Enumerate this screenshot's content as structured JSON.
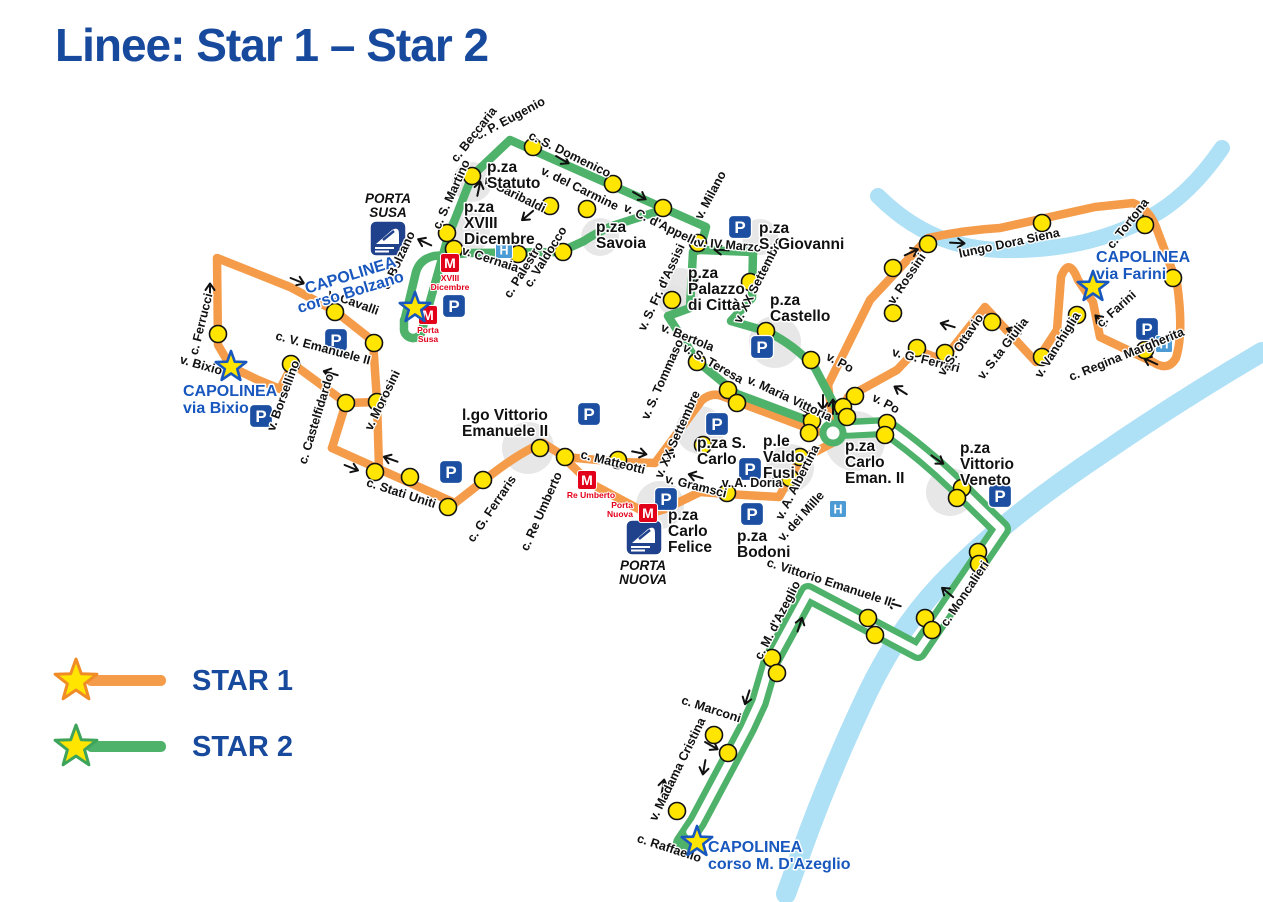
{
  "title": "Linee: Star 1 – Star 2",
  "colors": {
    "orange": "#F59C4B",
    "green": "#4FB26A",
    "stop_yellow": "#FFE500",
    "river": "#AEE0F6",
    "title_blue": "#17499D",
    "capolinea_blue": "#1857BE",
    "parking_blue": "#1C4FA1",
    "hospital_blue": "#4D9BD5",
    "metro_red": "#E2001A",
    "station_blue": "#20418C",
    "blob_gray": "#E3E3E3",
    "label_black": "#111111",
    "star_fill": "#FFE500"
  },
  "legend": {
    "items": [
      {
        "label": "STAR 1",
        "line_color": "#F59C4B",
        "star_stroke": "#F08C28"
      },
      {
        "label": "STAR 2",
        "line_color": "#4FB26A",
        "star_stroke": "#3FA45B"
      }
    ]
  },
  "map": {
    "rivers": [
      {
        "name": "river-dora",
        "d": "M878 196 Q930 248 1000 250 Q1080 252 1140 222 Q1185 202 1222 148",
        "width": 16
      },
      {
        "name": "river-po",
        "d": "M1262 352 Q1180 400 1100 455 Q1000 522 940 585 Q898 630 868 692 Q830 772 802 850 L786 894",
        "width": 20
      }
    ],
    "blobs": [
      [
        472,
        182,
        20
      ],
      [
        468,
        232,
        22
      ],
      [
        600,
        237,
        19
      ],
      [
        760,
        237,
        18
      ],
      [
        680,
        288,
        20
      ],
      [
        775,
        342,
        26
      ],
      [
        673,
        300,
        15
      ],
      [
        528,
        448,
        26
      ],
      [
        700,
        430,
        24
      ],
      [
        790,
        468,
        24
      ],
      [
        855,
        441,
        30
      ],
      [
        950,
        492,
        24
      ],
      [
        660,
        505,
        24
      ]
    ],
    "routes": {
      "star1_paths": [
        "M332 448 L346 403 L293 364 L280 389 L256 379 L231 367 L218 345 L217 258 L290 287 L335 311 L373 341 L377 401 L379 468",
        "M346 403 L377 402",
        "M332 448 L455 503 L487 478 Q520 452 543 443 L565 457 L620 462 L655 463 L702 400 Q712 392 722 396 L818 432",
        "M833 424 L828 385 L870 300 L928 238 Q965 230 1000 228 L1095 207 L1133 203 Q1149 209 1156 227 L1177 283 Q1184 332 1176 358 Q1168 372 1153 362 L1100 337 L1093 302 L1078 280 Q1069 256 1061 277 L1057 330 L1036 362 L985 307 L943 360 L916 350 L897 370 L848 397 L834 426",
        "M836 441 L800 460 L779 497 L727 494 L700 492 L665 509 L648 514 L590 483 L562 456"
      ],
      "star2_paths": [
        "M404 320 L404 328 A9 9 0 0 0 422 330 L448 237 L472 176 L510 140 L663 208 L706 227 L700 250 L753 252 L752 298 L731 321 L766 331 Q795 345 815 368 L836 408 L839 422",
        "M812 422 L737 394 L697 361 L668 316 L690 308 L693 252 L699 250",
        "M665 209 L612 226 Q594 234 584 241 L560 252 L470 253 L434 256 Q420 259 416 272 L405 318"
      ],
      "star2_double": "M841 429 L886 427 Q922 452 956 485 L1001 529 L918 651 L808 593 L771 661 L759 702 L747 728 L729 762 L697 822 L683 843",
      "star2_double_core": "M848 429 L886 427 Q922 452 956 485 L1001 529 L918 651 L808 593 L771 661 L759 702 L747 728 L729 762 L697 822 L690 832",
      "hook": [
        833,
        433,
        10
      ]
    },
    "stops": [
      [
        447,
        233
      ],
      [
        454,
        249
      ],
      [
        472,
        176
      ],
      [
        533,
        147
      ],
      [
        613,
        184
      ],
      [
        663,
        208
      ],
      [
        698,
        243
      ],
      [
        750,
        282
      ],
      [
        766,
        331
      ],
      [
        811,
        360
      ],
      [
        672,
        300
      ],
      [
        697,
        362
      ],
      [
        728,
        390
      ],
      [
        737,
        403
      ],
      [
        518,
        254
      ],
      [
        563,
        252
      ],
      [
        587,
        209
      ],
      [
        550,
        206
      ],
      [
        855,
        396
      ],
      [
        843,
        407
      ],
      [
        847,
        417
      ],
      [
        812,
        421
      ],
      [
        809,
        433
      ],
      [
        887,
        423
      ],
      [
        885,
        435
      ],
      [
        962,
        488
      ],
      [
        957,
        498
      ],
      [
        978,
        552
      ],
      [
        979,
        564
      ],
      [
        925,
        618
      ],
      [
        932,
        630
      ],
      [
        868,
        618
      ],
      [
        875,
        635
      ],
      [
        772,
        658
      ],
      [
        777,
        673
      ],
      [
        714,
        735
      ],
      [
        728,
        753
      ],
      [
        677,
        811
      ],
      [
        218,
        334
      ],
      [
        335,
        312
      ],
      [
        291,
        364
      ],
      [
        374,
        343
      ],
      [
        346,
        403
      ],
      [
        377,
        402
      ],
      [
        375,
        472
      ],
      [
        410,
        477
      ],
      [
        448,
        507
      ],
      [
        483,
        480
      ],
      [
        540,
        448
      ],
      [
        565,
        457
      ],
      [
        618,
        460
      ],
      [
        703,
        445
      ],
      [
        727,
        493
      ],
      [
        800,
        457
      ],
      [
        790,
        478
      ],
      [
        893,
        268
      ],
      [
        928,
        244
      ],
      [
        1042,
        223
      ],
      [
        1145,
        225
      ],
      [
        1173,
        278
      ],
      [
        1145,
        350
      ],
      [
        1077,
        315
      ],
      [
        1042,
        357
      ],
      [
        992,
        322
      ],
      [
        945,
        353
      ],
      [
        917,
        348
      ],
      [
        893,
        313
      ]
    ],
    "street_labels": [
      [
        "c. P. Eugenio",
        512,
        122,
        -28
      ],
      [
        "c. Beccaria",
        477,
        137,
        -52
      ],
      [
        "c. S. Martino",
        455,
        196,
        -66
      ],
      [
        "c. S. Domenico",
        568,
        158,
        26
      ],
      [
        "v. Garibaldi",
        513,
        198,
        26
      ],
      [
        "v. del Carmine",
        578,
        192,
        26
      ],
      [
        "v. C. d'Appello",
        661,
        229,
        26
      ],
      [
        "v. Milano",
        714,
        197,
        -62
      ],
      [
        "v. IV Marzo",
        729,
        249,
        5
      ],
      [
        "v. Cernaia",
        489,
        263,
        18
      ],
      [
        "c. Palestro",
        527,
        272,
        -58
      ],
      [
        "c. Valdocco",
        549,
        259,
        -58
      ],
      [
        "c. Bolzano",
        402,
        262,
        -65
      ],
      [
        "v. Cavalli",
        352,
        306,
        20
      ],
      [
        "c. Ferrucci",
        205,
        325,
        -76
      ],
      [
        "v. Bixio",
        200,
        369,
        16
      ],
      [
        "v. Borsellino",
        287,
        397,
        -70
      ],
      [
        "c. V. Emanuele II",
        322,
        352,
        15
      ],
      [
        "c. Castelfidardo",
        320,
        420,
        -73
      ],
      [
        "v. Morosini",
        386,
        402,
        -64
      ],
      [
        "c. Stati Uniti",
        400,
        497,
        18
      ],
      [
        "c. G. Ferraris",
        495,
        511,
        -56
      ],
      [
        "c. Re Umberto",
        545,
        513,
        -66
      ],
      [
        "c. Matteotti",
        612,
        466,
        14
      ],
      [
        "v. Gramsci",
        695,
        490,
        14
      ],
      [
        "v. A. Doria",
        752,
        487,
        0
      ],
      [
        "v. A. Albertina",
        801,
        484,
        -63
      ],
      [
        "v. dei Mille",
        804,
        519,
        -48
      ],
      [
        "v. XX Settembre",
        762,
        282,
        -63
      ],
      [
        "v. XX Settembre",
        681,
        436,
        -66
      ],
      [
        "v. S. Fr. d'Assisi",
        665,
        289,
        -65
      ],
      [
        "v. Bertola",
        686,
        341,
        22
      ],
      [
        "v. S. Teresa",
        711,
        367,
        30
      ],
      [
        "v. S. Tommaso",
        666,
        381,
        -66
      ],
      [
        "v. Maria Vittoria",
        788,
        402,
        25
      ],
      [
        "v. Po",
        838,
        366,
        28
      ],
      [
        "v. Po",
        884,
        407,
        28
      ],
      [
        "v. Rossini",
        910,
        281,
        -56
      ],
      [
        "v. G. Ferrari",
        925,
        364,
        14
      ],
      [
        "v. S. Ottavio",
        964,
        347,
        -56
      ],
      [
        "v. S.ta Giulia",
        1006,
        351,
        -52
      ],
      [
        "v. Vanchiglia",
        1061,
        347,
        -58
      ],
      [
        "lungo Dora Siena",
        1010,
        247,
        -12
      ],
      [
        "c. Tortona",
        1131,
        226,
        -52
      ],
      [
        "c. Farini",
        1119,
        312,
        -42
      ],
      [
        "c. Regina Margherita",
        1128,
        358,
        -22
      ],
      [
        "c. Moncalieri",
        968,
        596,
        -56
      ],
      [
        "c. Vittorio Emanuele II",
        828,
        586,
        18
      ],
      [
        "c. M. d'Azeglio",
        781,
        622,
        -63
      ],
      [
        "c. Marconi",
        710,
        713,
        18
      ],
      [
        "v. Madama Cristina",
        681,
        771,
        -64
      ],
      [
        "c. Raffaello",
        668,
        852,
        18
      ]
    ],
    "place_labels": [
      {
        "lines": [
          "p.za",
          "Statuto"
        ],
        "x": 487,
        "y": 172
      },
      {
        "lines": [
          "p.za",
          "XVIII",
          "Dicembre"
        ],
        "x": 464,
        "y": 212
      },
      {
        "lines": [
          "p.za",
          "Savoia"
        ],
        "x": 596,
        "y": 232
      },
      {
        "lines": [
          "p.za",
          "S. Giovanni"
        ],
        "x": 759,
        "y": 233
      },
      {
        "lines": [
          "p.za",
          "Palazzo",
          "di Città"
        ],
        "x": 688,
        "y": 278
      },
      {
        "lines": [
          "p.za",
          "Castello"
        ],
        "x": 770,
        "y": 305
      },
      {
        "lines": [
          "p.za S.",
          "Carlo"
        ],
        "x": 697,
        "y": 448
      },
      {
        "lines": [
          "p.le",
          "Valdo",
          "Fusi"
        ],
        "x": 763,
        "y": 446
      },
      {
        "lines": [
          "p.za",
          "Carlo",
          "Eman. II"
        ],
        "x": 845,
        "y": 451
      },
      {
        "lines": [
          "p.za",
          "Carlo",
          "Felice"
        ],
        "x": 668,
        "y": 520
      },
      {
        "lines": [
          "p.za",
          "Bodoni"
        ],
        "x": 737,
        "y": 541
      },
      {
        "lines": [
          "p.za",
          "Vittorio",
          "Veneto"
        ],
        "x": 960,
        "y": 453
      },
      {
        "lines": [
          "l.go Vittorio",
          "Emanuele II"
        ],
        "x": 462,
        "y": 420
      }
    ],
    "capolinea": [
      {
        "lines": [
          "CAPOLINEA",
          "corso Bolzano"
        ],
        "x": 352,
        "y": 280,
        "rot": -17,
        "anchor": "middle",
        "star": [
          415,
          308
        ]
      },
      {
        "lines": [
          "CAPOLINEA",
          "via Bixio"
        ],
        "x": 183,
        "y": 396,
        "rot": 0,
        "anchor": "start",
        "star": [
          231,
          367
        ]
      },
      {
        "lines": [
          "CAPOLINEA",
          "via Farini"
        ],
        "x": 1096,
        "y": 262,
        "rot": 0,
        "anchor": "start",
        "star": [
          1093,
          287
        ]
      },
      {
        "lines": [
          "CAPOLINEA",
          "corso M. D'Azeglio"
        ],
        "x": 708,
        "y": 852,
        "rot": 0,
        "anchor": "start",
        "star": [
          697,
          842
        ]
      }
    ],
    "stations": [
      {
        "lines": [
          "PORTA",
          "SUSA"
        ],
        "label_x": 388,
        "label_y": 203,
        "icon_x": 370,
        "icon_y": 221
      },
      {
        "lines": [
          "PORTA",
          "NUOVA"
        ],
        "label_x": 643,
        "label_y": 570,
        "icon_x": 626,
        "icon_y": 520
      }
    ],
    "parking_icons": [
      [
        336,
        340
      ],
      [
        261,
        416
      ],
      [
        454,
        306
      ],
      [
        740,
        227
      ],
      [
        762,
        347
      ],
      [
        589,
        414
      ],
      [
        451,
        472
      ],
      [
        717,
        424
      ],
      [
        750,
        469
      ],
      [
        752,
        514
      ],
      [
        666,
        499
      ],
      [
        1000,
        496
      ],
      [
        1147,
        329
      ]
    ],
    "hospital_icons": [
      [
        504,
        250
      ],
      [
        838,
        509
      ],
      [
        1164,
        344
      ]
    ],
    "metro_icons": [
      {
        "x": 450,
        "y": 263,
        "label": [
          "XVIII",
          "Dicembre"
        ],
        "lx": 450,
        "ly": 281,
        "anchor": "middle"
      },
      {
        "x": 428,
        "y": 315,
        "label": [
          "Porta",
          "Susa"
        ],
        "lx": 428,
        "ly": 333,
        "anchor": "middle"
      },
      {
        "x": 587,
        "y": 480,
        "label": [
          "Re Umberto"
        ],
        "lx": 591,
        "ly": 498,
        "anchor": "middle"
      },
      {
        "x": 648,
        "y": 513,
        "label": [
          "Porta",
          "Nuova"
        ],
        "lx": 633,
        "ly": 508,
        "anchor": "end"
      }
    ],
    "arrows": [
      [
        563,
        160,
        30
      ],
      [
        640,
        196,
        30
      ],
      [
        479,
        188,
        -78
      ],
      [
        527,
        216,
        140
      ],
      [
        424,
        242,
        205
      ],
      [
        210,
        290,
        -90
      ],
      [
        298,
        281,
        22
      ],
      [
        330,
        373,
        196
      ],
      [
        390,
        459,
        200
      ],
      [
        352,
        468,
        22
      ],
      [
        640,
        453,
        12
      ],
      [
        670,
        455,
        -65
      ],
      [
        695,
        476,
        196
      ],
      [
        806,
        412,
        33
      ],
      [
        833,
        406,
        -90
      ],
      [
        841,
        414,
        -90
      ],
      [
        823,
        403,
        90
      ],
      [
        900,
        390,
        -148
      ],
      [
        938,
        460,
        35
      ],
      [
        947,
        592,
        -140
      ],
      [
        982,
        563,
        42
      ],
      [
        893,
        604,
        196
      ],
      [
        800,
        624,
        -72
      ],
      [
        747,
        698,
        108
      ],
      [
        712,
        746,
        30
      ],
      [
        663,
        786,
        -80
      ],
      [
        704,
        768,
        100
      ],
      [
        912,
        252,
        -25
      ],
      [
        958,
        243,
        3
      ],
      [
        1148,
        222,
        52
      ],
      [
        1100,
        320,
        -135
      ],
      [
        1013,
        331,
        200
      ],
      [
        947,
        325,
        196
      ],
      [
        721,
        250,
        183
      ],
      [
        694,
        278,
        100
      ],
      [
        1150,
        361,
        205
      ]
    ]
  }
}
